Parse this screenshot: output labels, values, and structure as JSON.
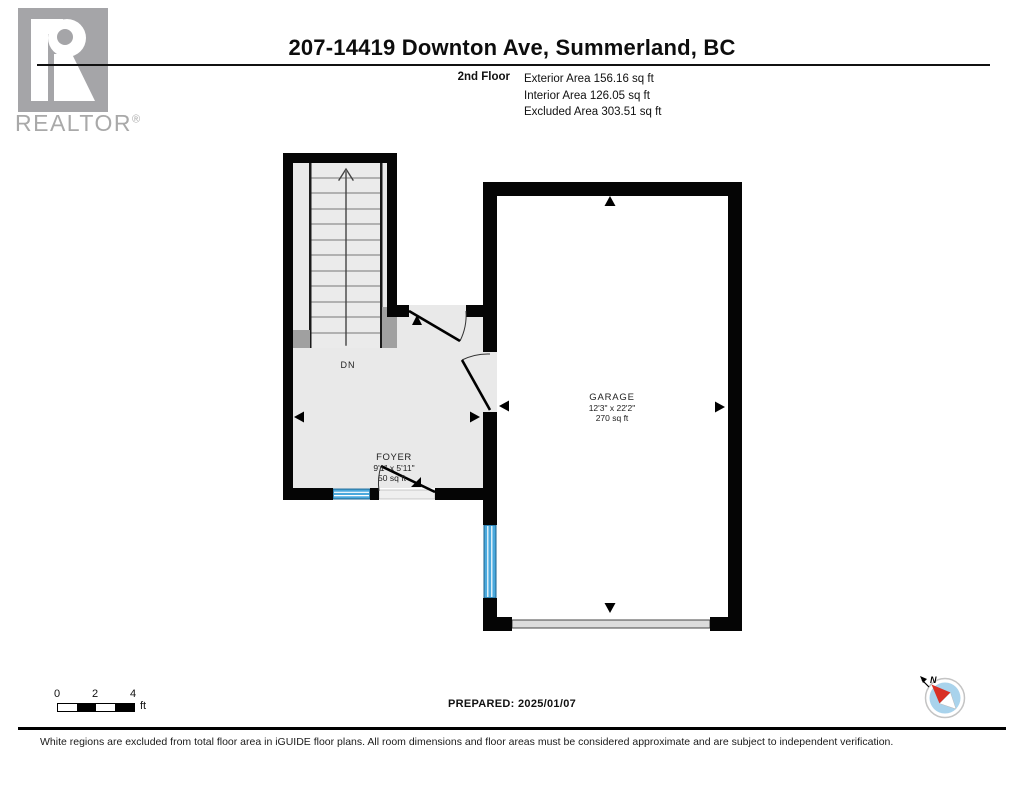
{
  "branding": {
    "logo_letter": "R",
    "logo_wordmark": "REALTOR",
    "registered_symbol": "®"
  },
  "header": {
    "title": "207-14419 Downton Ave, Summerland, BC",
    "floor_label": "2nd Floor",
    "area_lines": [
      "Exterior Area 156.16 sq ft",
      "Interior Area 126.05 sq ft",
      "Excluded Area 303.51 sq ft"
    ]
  },
  "floor_plan": {
    "stair_direction_label": "DN",
    "rooms": [
      {
        "name": "FOYER",
        "dimensions": "9'1\" x 5'11\"",
        "area": "50 sq ft"
      },
      {
        "name": "GARAGE",
        "dimensions": "12'3\" x 22'2\"",
        "area": "270 sq ft"
      }
    ],
    "colors": {
      "wall": "#000000",
      "interior_floor": "#e9e9e9",
      "window": "#4aa9dd",
      "excluded_region": "#ffffff",
      "stair_stub_gray": "#a0a0a0"
    }
  },
  "scale_bar": {
    "ticks": [
      "0",
      "2",
      "4"
    ],
    "unit": "ft"
  },
  "prepared_line": "PREPARED: 2025/01/07",
  "compass": {
    "north_label": "N",
    "disc_color": "#a9d3ec",
    "needle_color": "#d93025"
  },
  "footer": {
    "disclaimer": "White regions are excluded from total floor area in iGUIDE floor plans. All room dimensions and floor areas must be considered approximate and are subject to independent verification."
  }
}
